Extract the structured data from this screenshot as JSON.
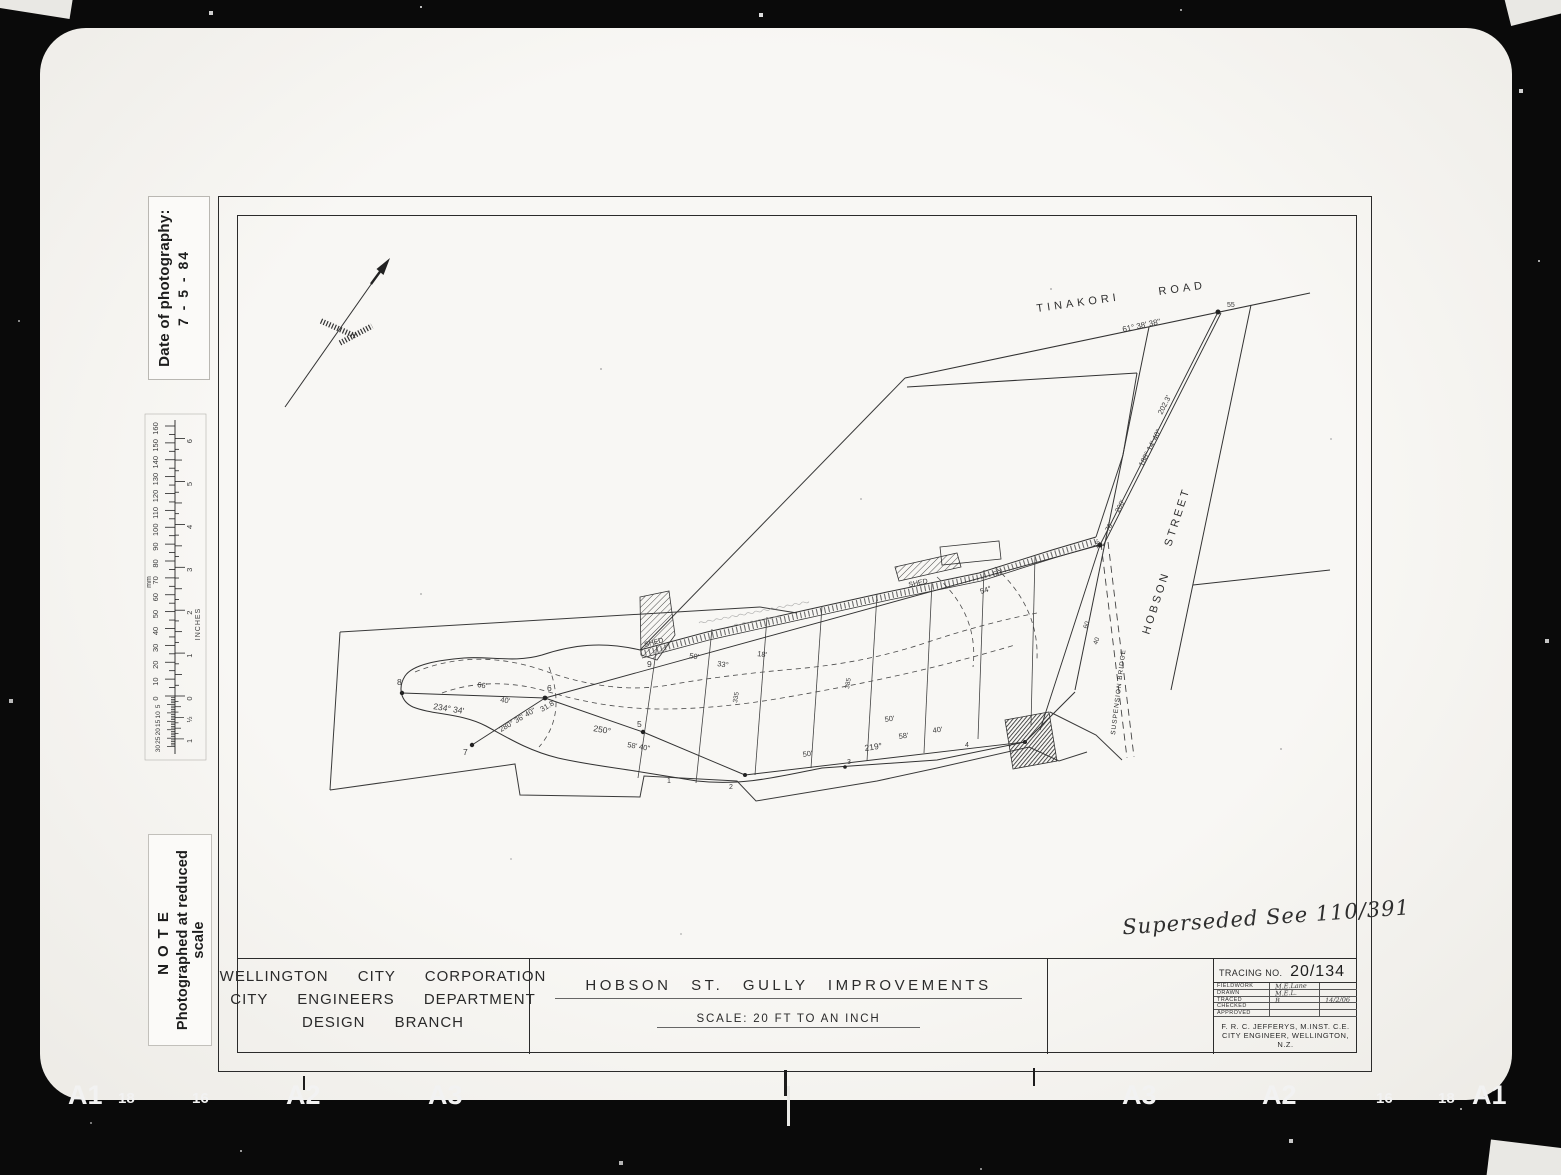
{
  "film": {
    "bottom_markers_left": [
      {
        "text": "A1",
        "x": 68,
        "big": true
      },
      {
        "text": "18",
        "x": 118,
        "big": false
      },
      {
        "text": "16",
        "x": 192,
        "big": false
      },
      {
        "text": "A2",
        "x": 286,
        "big": true
      },
      {
        "text": "A3",
        "x": 428,
        "big": true
      }
    ],
    "bottom_markers_right": [
      {
        "text": "A3",
        "x": 1122,
        "big": true
      },
      {
        "text": "A2",
        "x": 1262,
        "big": true
      },
      {
        "text": "16",
        "x": 1376,
        "big": false
      },
      {
        "text": "18",
        "x": 1438,
        "big": false
      },
      {
        "text": "A1",
        "x": 1472,
        "big": true
      }
    ]
  },
  "margin": {
    "date_label": "Date of photography:",
    "date_value": "7 - 5 - 84",
    "note_title": "NOTE",
    "note_text": "Photographed at reduced scale",
    "ruler": {
      "mm_label": "mm",
      "inches_label": "INCHES",
      "mm_max": 160,
      "mm_label_step": 10,
      "inch_max": 6,
      "sub_mm": 30,
      "half_inch_label": "½"
    }
  },
  "sheet": {
    "org_line1": "WELLINGTON CITY CORPORATION",
    "org_line2": "CITY ENGINEERS DEPARTMENT",
    "org_line3": "DESIGN BRANCH",
    "title": "HOBSON ST. GULLY IMPROVEMENTS",
    "scale_note": "SCALE: 20 FT TO AN INCH",
    "tracing_label": "TRACING NO.",
    "tracing_number": "20/134",
    "approval_rows": [
      {
        "label": "FIELDWORK",
        "value": "M.E.Lane",
        "extra": ""
      },
      {
        "label": "DRAWN",
        "value": "M.E.L.",
        "extra": ""
      },
      {
        "label": "TRACED",
        "value": "B",
        "extra": "14/2/06"
      },
      {
        "label": "CHECKED",
        "value": "",
        "extra": ""
      },
      {
        "label": "APPROVED",
        "value": "",
        "extra": ""
      }
    ],
    "engineer_line1": "F. R. C. JEFFERYS, M.INST. C.E.",
    "engineer_line2": "CITY ENGINEER, WELLINGTON, N.Z.",
    "superseded_note": "Superseded See 110/391"
  },
  "plan": {
    "labels": {
      "tinakori": "TINAKORI",
      "road": "ROAD",
      "hobson": "HOBSON",
      "street": "STREET",
      "suspension_bridge": "SUSPENSION BRIDGE",
      "shed1": "SHED",
      "shed2": "SHED"
    },
    "annotations": [
      {
        "x": 886,
        "y": 117,
        "r": -12,
        "s": 8,
        "t": "61° 38' 38\""
      },
      {
        "x": 990,
        "y": 92,
        "r": 0,
        "s": 7,
        "t": "55"
      },
      {
        "x": 906,
        "y": 252,
        "r": -63,
        "s": 7.5,
        "t": "188° 14' 40\""
      },
      {
        "x": 925,
        "y": 200,
        "r": -63,
        "s": 7.5,
        "t": "202.3'"
      },
      {
        "x": 882,
        "y": 298,
        "r": -63,
        "s": 7,
        "t": "200'"
      },
      {
        "x": 872,
        "y": 317,
        "r": -63,
        "s": 7,
        "t": "70'"
      },
      {
        "x": 860,
        "y": 334,
        "r": -63,
        "s": 7,
        "t": "16'"
      },
      {
        "x": 196,
        "y": 494,
        "r": 9,
        "s": 8.5,
        "t": "234° 34'"
      },
      {
        "x": 240,
        "y": 472,
        "r": 9,
        "s": 7.5,
        "t": "66'"
      },
      {
        "x": 263,
        "y": 487,
        "r": 9,
        "s": 7.5,
        "t": "40'"
      },
      {
        "x": 264,
        "y": 517,
        "r": -30,
        "s": 7.5,
        "t": "280° 36' 40\""
      },
      {
        "x": 305,
        "y": 497,
        "r": -30,
        "s": 7.5,
        "t": "31.8'"
      },
      {
        "x": 356,
        "y": 516,
        "r": 10,
        "s": 8.5,
        "t": "250°"
      },
      {
        "x": 390,
        "y": 532,
        "r": 10,
        "s": 7.5,
        "t": "58' 40\""
      },
      {
        "x": 628,
        "y": 536,
        "r": -8,
        "s": 8.5,
        "t": "219°"
      },
      {
        "x": 566,
        "y": 542,
        "r": -8,
        "s": 7.5,
        "t": "50'"
      },
      {
        "x": 662,
        "y": 524,
        "r": -8,
        "s": 7.5,
        "t": "58'"
      },
      {
        "x": 696,
        "y": 518,
        "r": -8,
        "s": 7.5,
        "t": "40'"
      },
      {
        "x": 648,
        "y": 507,
        "r": -8,
        "s": 7.5,
        "t": "50'"
      },
      {
        "x": 452,
        "y": 443,
        "r": 8,
        "s": 7.5,
        "t": "50'"
      },
      {
        "x": 480,
        "y": 451,
        "r": 8,
        "s": 7.5,
        "t": "33°"
      },
      {
        "x": 520,
        "y": 441,
        "r": 8,
        "s": 7.5,
        "t": "18'"
      },
      {
        "x": 744,
        "y": 379,
        "r": -18,
        "s": 7.5,
        "t": "54°"
      },
      {
        "x": 757,
        "y": 362,
        "r": -18,
        "s": 7.5,
        "t": "50'"
      },
      {
        "x": 160,
        "y": 470,
        "r": 0,
        "s": 8.5,
        "t": "8"
      },
      {
        "x": 226,
        "y": 540,
        "r": 0,
        "s": 8.5,
        "t": "7"
      },
      {
        "x": 310,
        "y": 476,
        "r": 0,
        "s": 8.5,
        "t": "6"
      },
      {
        "x": 400,
        "y": 512,
        "r": 0,
        "s": 8.5,
        "t": "5"
      },
      {
        "x": 410,
        "y": 452,
        "r": 0,
        "s": 8.5,
        "t": "9"
      },
      {
        "x": 430,
        "y": 568,
        "r": 0,
        "s": 7,
        "t": "1"
      },
      {
        "x": 492,
        "y": 574,
        "r": 0,
        "s": 7,
        "t": "2"
      },
      {
        "x": 610,
        "y": 549,
        "r": 0,
        "s": 7,
        "t": "3"
      },
      {
        "x": 728,
        "y": 532,
        "r": 0,
        "s": 7,
        "t": "4"
      },
      {
        "x": 500,
        "y": 488,
        "r": -80,
        "s": 6.5,
        "t": "335"
      },
      {
        "x": 612,
        "y": 474,
        "r": -80,
        "s": 6.5,
        "t": "385"
      },
      {
        "x": 860,
        "y": 430,
        "r": -70,
        "s": 6.5,
        "t": "40"
      },
      {
        "x": 850,
        "y": 414,
        "r": -70,
        "s": 6.5,
        "t": "60"
      }
    ]
  }
}
